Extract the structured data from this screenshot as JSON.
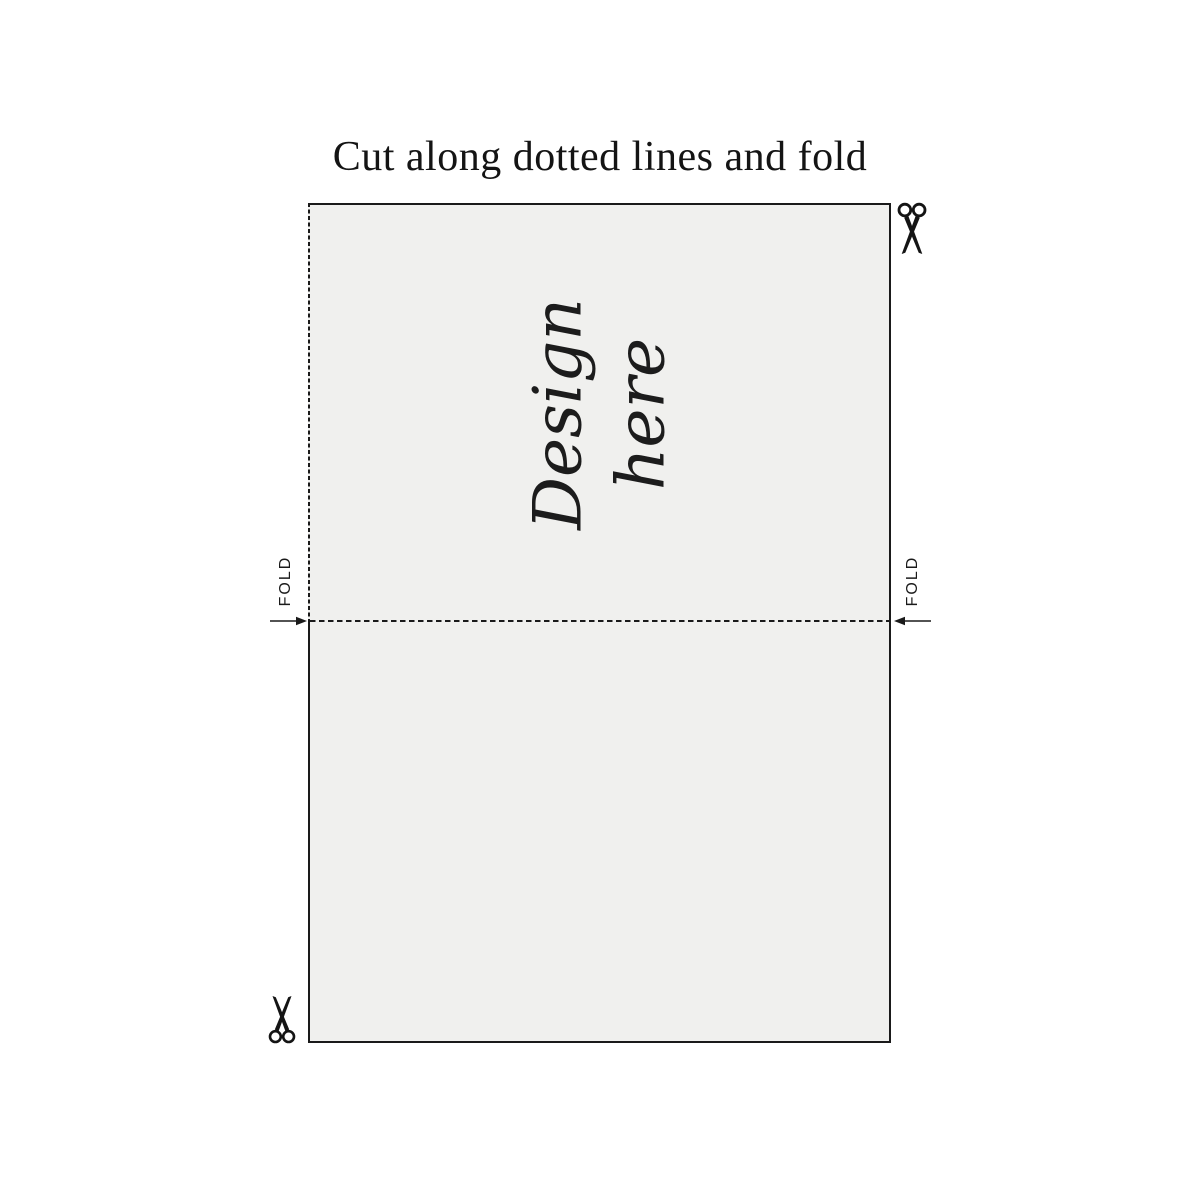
{
  "title": "Cut along dotted lines and fold",
  "card": {
    "design_line1": "Design",
    "design_line2": "here"
  },
  "fold": {
    "left_label": "FOLD",
    "right_label": "FOLD"
  },
  "icons": {
    "top_right": "scissors-icon",
    "bottom_left": "scissors-icon",
    "left_arrow": "arrow-right-icon",
    "right_arrow": "arrow-left-icon"
  },
  "colors": {
    "page_background": "#ffffff",
    "card_fill": "#f0f0ee",
    "line_color": "#1a1a1a",
    "text_color": "#141414"
  }
}
